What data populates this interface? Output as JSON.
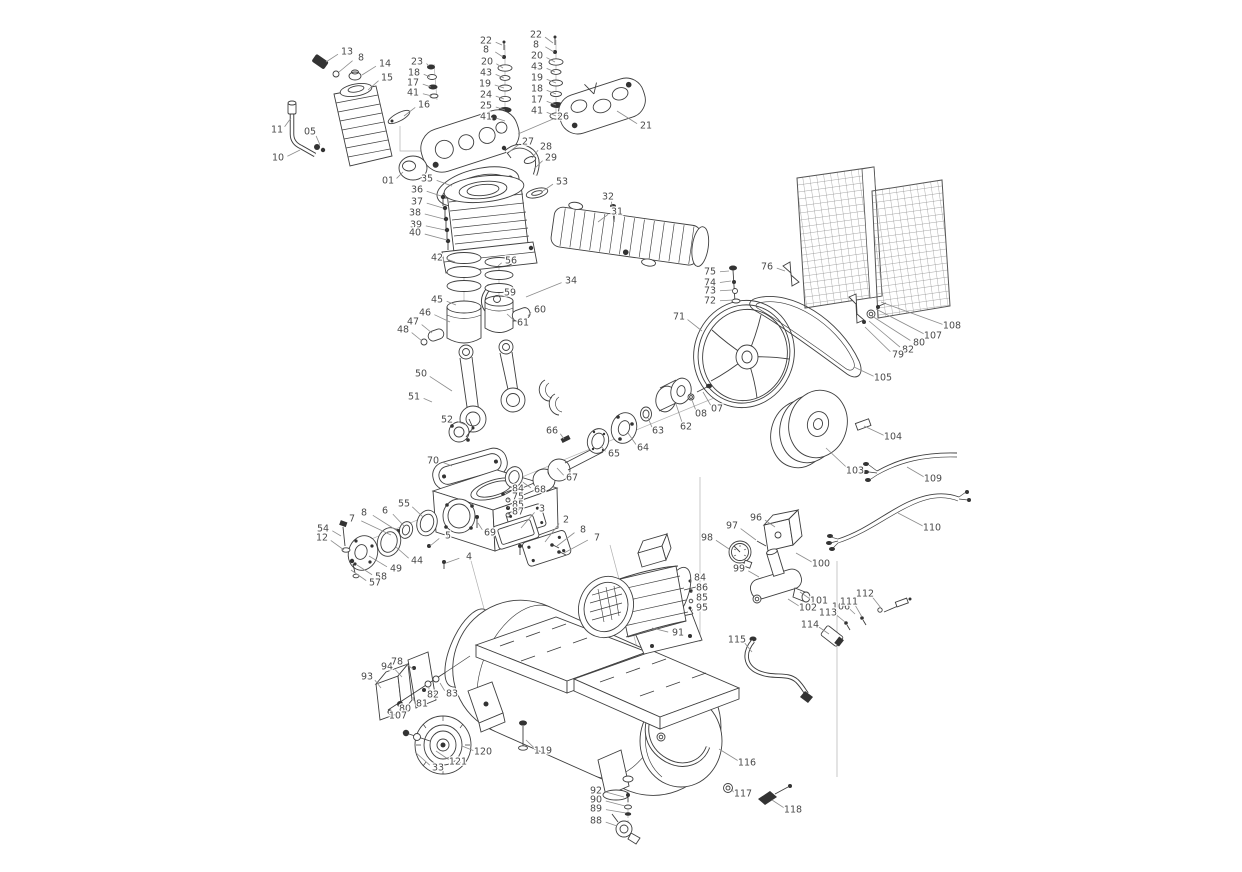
{
  "page": {
    "background": "#ffffff",
    "width": 1242,
    "height": 872
  },
  "diagram": {
    "type": "exploded-parts-diagram",
    "subject": "belt-driven air compressor exploded view with numbered part callouts",
    "label_style": {
      "color": "#4a4a4a",
      "leader_color": "#8c8c8c",
      "ink_color": "#3f3f3f",
      "font_size": 9.5
    },
    "callouts": [
      {
        "n": "13",
        "x": 347,
        "y": 52,
        "tx": 326,
        "ty": 62
      },
      {
        "n": "8",
        "x": 361,
        "y": 58,
        "tx": 339,
        "ty": 72
      },
      {
        "n": "14",
        "x": 385,
        "y": 64,
        "tx": 362,
        "ty": 75
      },
      {
        "n": "15",
        "x": 387,
        "y": 78,
        "tx": 368,
        "ty": 90
      },
      {
        "n": "11",
        "x": 277,
        "y": 130,
        "tx": 291,
        "ty": 118
      },
      {
        "n": "05",
        "x": 310,
        "y": 132,
        "tx": 320,
        "ty": 145
      },
      {
        "n": "10",
        "x": 278,
        "y": 158,
        "tx": 300,
        "ty": 150
      },
      {
        "n": "16",
        "x": 424,
        "y": 105,
        "tx": 404,
        "ty": 116
      },
      {
        "n": "01",
        "x": 388,
        "y": 181,
        "tx": 403,
        "ty": 172
      },
      {
        "n": "23",
        "x": 417,
        "y": 62,
        "tx": 429,
        "ty": 66
      },
      {
        "n": "18",
        "x": 414,
        "y": 73,
        "tx": 430,
        "ty": 77
      },
      {
        "n": "17",
        "x": 413,
        "y": 83,
        "tx": 431,
        "ty": 87
      },
      {
        "n": "41",
        "x": 413,
        "y": 93,
        "tx": 432,
        "ty": 96
      },
      {
        "n": "22",
        "x": 486,
        "y": 41,
        "tx": 502,
        "ty": 45
      },
      {
        "n": "8",
        "x": 486,
        "y": 50,
        "tx": 503,
        "ty": 57
      },
      {
        "n": "20",
        "x": 487,
        "y": 62,
        "tx": 503,
        "ty": 68
      },
      {
        "n": "43",
        "x": 486,
        "y": 73,
        "tx": 504,
        "ty": 78
      },
      {
        "n": "19",
        "x": 485,
        "y": 84,
        "tx": 504,
        "ty": 88
      },
      {
        "n": "24",
        "x": 486,
        "y": 95,
        "tx": 504,
        "ty": 99
      },
      {
        "n": "25",
        "x": 486,
        "y": 106,
        "tx": 505,
        "ty": 110
      },
      {
        "n": "41",
        "x": 486,
        "y": 117,
        "tx": 505,
        "ty": 121
      },
      {
        "n": "22",
        "x": 536,
        "y": 35,
        "tx": 553,
        "ty": 43
      },
      {
        "n": "8",
        "x": 536,
        "y": 45,
        "tx": 554,
        "ty": 52
      },
      {
        "n": "20",
        "x": 537,
        "y": 56,
        "tx": 555,
        "ty": 62
      },
      {
        "n": "43",
        "x": 537,
        "y": 67,
        "tx": 555,
        "ty": 72
      },
      {
        "n": "19",
        "x": 537,
        "y": 78,
        "tx": 556,
        "ty": 83
      },
      {
        "n": "18",
        "x": 537,
        "y": 89,
        "tx": 556,
        "ty": 94
      },
      {
        "n": "17",
        "x": 537,
        "y": 100,
        "tx": 556,
        "ty": 105
      },
      {
        "n": "41",
        "x": 537,
        "y": 111,
        "tx": 556,
        "ty": 116
      },
      {
        "n": "26",
        "x": 563,
        "y": 117,
        "tx": 518,
        "ty": 134
      },
      {
        "n": "21",
        "x": 646,
        "y": 126,
        "tx": 617,
        "ty": 111
      },
      {
        "n": "27",
        "x": 528,
        "y": 142,
        "tx": 509,
        "ty": 152
      },
      {
        "n": "28",
        "x": 546,
        "y": 147,
        "tx": 532,
        "ty": 158
      },
      {
        "n": "29",
        "x": 551,
        "y": 158,
        "tx": 534,
        "ty": 169
      },
      {
        "n": "53",
        "x": 562,
        "y": 182,
        "tx": 543,
        "ty": 191
      },
      {
        "n": "32",
        "x": 608,
        "y": 197,
        "tx": 613,
        "ty": 211
      },
      {
        "n": "31",
        "x": 617,
        "y": 212,
        "tx": 598,
        "ty": 222
      },
      {
        "n": "34",
        "x": 571,
        "y": 281,
        "tx": 526,
        "ty": 297
      },
      {
        "n": "35",
        "x": 427,
        "y": 179,
        "tx": 452,
        "ty": 186
      },
      {
        "n": "36",
        "x": 417,
        "y": 190,
        "tx": 441,
        "ty": 196
      },
      {
        "n": "37",
        "x": 417,
        "y": 202,
        "tx": 443,
        "ty": 208
      },
      {
        "n": "38",
        "x": 415,
        "y": 213,
        "tx": 444,
        "ty": 219
      },
      {
        "n": "39",
        "x": 416,
        "y": 225,
        "tx": 445,
        "ty": 230
      },
      {
        "n": "40",
        "x": 415,
        "y": 233,
        "tx": 447,
        "ty": 240
      },
      {
        "n": "42",
        "x": 437,
        "y": 258,
        "tx": 455,
        "ty": 262
      },
      {
        "n": "56",
        "x": 511,
        "y": 261,
        "tx": 498,
        "ty": 266
      },
      {
        "n": "59",
        "x": 510,
        "y": 293,
        "tx": 500,
        "ty": 298
      },
      {
        "n": "60",
        "x": 540,
        "y": 310,
        "tx": 528,
        "ty": 316
      },
      {
        "n": "61",
        "x": 523,
        "y": 323,
        "tx": 507,
        "ty": 314
      },
      {
        "n": "45",
        "x": 437,
        "y": 300,
        "tx": 456,
        "ty": 305
      },
      {
        "n": "46",
        "x": 425,
        "y": 313,
        "tx": 450,
        "ty": 322
      },
      {
        "n": "47",
        "x": 413,
        "y": 322,
        "tx": 432,
        "ty": 333
      },
      {
        "n": "48",
        "x": 403,
        "y": 330,
        "tx": 422,
        "ty": 341
      },
      {
        "n": "50",
        "x": 421,
        "y": 374,
        "tx": 452,
        "ty": 391
      },
      {
        "n": "51",
        "x": 414,
        "y": 397,
        "tx": 432,
        "ty": 402
      },
      {
        "n": "52",
        "x": 447,
        "y": 420,
        "tx": 466,
        "ty": 425
      },
      {
        "n": "66",
        "x": 552,
        "y": 431,
        "tx": 564,
        "ty": 439
      },
      {
        "n": "65",
        "x": 614,
        "y": 454,
        "tx": 601,
        "ty": 446
      },
      {
        "n": "64",
        "x": 643,
        "y": 448,
        "tx": 628,
        "ty": 433
      },
      {
        "n": "63",
        "x": 658,
        "y": 431,
        "tx": 648,
        "ty": 418
      },
      {
        "n": "62",
        "x": 686,
        "y": 427,
        "tx": 676,
        "ty": 404
      },
      {
        "n": "08",
        "x": 701,
        "y": 414,
        "tx": 692,
        "ty": 400
      },
      {
        "n": "07",
        "x": 717,
        "y": 409,
        "tx": 703,
        "ty": 392
      },
      {
        "n": "67",
        "x": 572,
        "y": 478,
        "tx": 557,
        "ty": 468
      },
      {
        "n": "68",
        "x": 540,
        "y": 490,
        "tx": 521,
        "ty": 481
      },
      {
        "n": "70",
        "x": 433,
        "y": 461,
        "tx": 452,
        "ty": 466
      },
      {
        "n": "55",
        "x": 404,
        "y": 504,
        "tx": 423,
        "ty": 517
      },
      {
        "n": "6",
        "x": 385,
        "y": 511,
        "tx": 404,
        "ty": 526
      },
      {
        "n": "8",
        "x": 364,
        "y": 513,
        "tx": 396,
        "ty": 530
      },
      {
        "n": "7",
        "x": 352,
        "y": 519,
        "tx": 391,
        "ty": 535
      },
      {
        "n": "54",
        "x": 323,
        "y": 529,
        "tx": 341,
        "ty": 536
      },
      {
        "n": "12",
        "x": 322,
        "y": 538,
        "tx": 344,
        "ty": 550
      },
      {
        "n": "44",
        "x": 417,
        "y": 561,
        "tx": 396,
        "ty": 547
      },
      {
        "n": "49",
        "x": 396,
        "y": 569,
        "tx": 369,
        "ty": 556
      },
      {
        "n": "58",
        "x": 381,
        "y": 577,
        "tx": 357,
        "ty": 565
      },
      {
        "n": "57",
        "x": 375,
        "y": 583,
        "tx": 351,
        "ty": 570
      },
      {
        "n": "69",
        "x": 490,
        "y": 533,
        "tx": 478,
        "ty": 523
      },
      {
        "n": "5",
        "x": 448,
        "y": 536,
        "tx": 430,
        "ty": 546
      },
      {
        "n": "4",
        "x": 469,
        "y": 557,
        "tx": 446,
        "ty": 563
      },
      {
        "n": "3",
        "x": 542,
        "y": 509,
        "tx": 521,
        "ty": 528
      },
      {
        "n": "2",
        "x": 566,
        "y": 520,
        "tx": 545,
        "ty": 542
      },
      {
        "n": "8",
        "x": 583,
        "y": 530,
        "tx": 557,
        "ty": 546
      },
      {
        "n": "7",
        "x": 597,
        "y": 538,
        "tx": 564,
        "ty": 553
      },
      {
        "n": "84",
        "x": 518,
        "y": 489,
        "tx": 509,
        "ty": 492
      },
      {
        "n": "75",
        "x": 518,
        "y": 497,
        "tx": 508,
        "ty": 500
      },
      {
        "n": "85",
        "x": 518,
        "y": 505,
        "tx": 508,
        "ty": 508
      },
      {
        "n": "87",
        "x": 518,
        "y": 512,
        "tx": 508,
        "ty": 515
      },
      {
        "n": "71",
        "x": 679,
        "y": 317,
        "tx": 702,
        "ty": 331
      },
      {
        "n": "75",
        "x": 710,
        "y": 272,
        "tx": 729,
        "ty": 271
      },
      {
        "n": "74",
        "x": 710,
        "y": 283,
        "tx": 731,
        "ty": 281
      },
      {
        "n": "73",
        "x": 710,
        "y": 291,
        "tx": 732,
        "ty": 290
      },
      {
        "n": "72",
        "x": 710,
        "y": 301,
        "tx": 733,
        "ty": 300
      },
      {
        "n": "76",
        "x": 767,
        "y": 267,
        "tx": 785,
        "ty": 271
      },
      {
        "n": "105",
        "x": 883,
        "y": 378,
        "tx": 854,
        "ty": 367
      },
      {
        "n": "108",
        "x": 952,
        "y": 326,
        "tx": 881,
        "ty": 302
      },
      {
        "n": "107",
        "x": 933,
        "y": 336,
        "tx": 876,
        "ty": 309
      },
      {
        "n": "80",
        "x": 919,
        "y": 343,
        "tx": 872,
        "ty": 316
      },
      {
        "n": "82",
        "x": 908,
        "y": 350,
        "tx": 869,
        "ty": 321
      },
      {
        "n": "79",
        "x": 898,
        "y": 355,
        "tx": 865,
        "ty": 327
      },
      {
        "n": "104",
        "x": 893,
        "y": 437,
        "tx": 864,
        "ty": 426
      },
      {
        "n": "103",
        "x": 855,
        "y": 471,
        "tx": 826,
        "ty": 448
      },
      {
        "n": "109",
        "x": 933,
        "y": 479,
        "tx": 907,
        "ty": 467
      },
      {
        "n": "110",
        "x": 932,
        "y": 528,
        "tx": 898,
        "ty": 513
      },
      {
        "n": "96",
        "x": 756,
        "y": 518,
        "tx": 775,
        "ty": 527
      },
      {
        "n": "97",
        "x": 732,
        "y": 526,
        "tx": 756,
        "ty": 540
      },
      {
        "n": "98",
        "x": 707,
        "y": 538,
        "tx": 729,
        "ty": 549
      },
      {
        "n": "99",
        "x": 739,
        "y": 569,
        "tx": 759,
        "ty": 577
      },
      {
        "n": "100",
        "x": 821,
        "y": 564,
        "tx": 796,
        "ty": 553
      },
      {
        "n": "101",
        "x": 819,
        "y": 601,
        "tx": 800,
        "ty": 592
      },
      {
        "n": "102",
        "x": 808,
        "y": 608,
        "tx": 788,
        "ty": 599
      },
      {
        "n": "106",
        "x": 841,
        "y": 607,
        "tx": 855,
        "ty": 614
      },
      {
        "n": "111",
        "x": 849,
        "y": 602,
        "tx": 862,
        "ty": 617
      },
      {
        "n": "112",
        "x": 865,
        "y": 594,
        "tx": 881,
        "ty": 608
      },
      {
        "n": "113",
        "x": 828,
        "y": 613,
        "tx": 845,
        "ty": 622
      },
      {
        "n": "114",
        "x": 810,
        "y": 625,
        "tx": 829,
        "ty": 634
      },
      {
        "n": "115",
        "x": 737,
        "y": 640,
        "tx": 752,
        "ty": 652
      },
      {
        "n": "91",
        "x": 678,
        "y": 633,
        "tx": 652,
        "ty": 628
      },
      {
        "n": "84",
        "x": 700,
        "y": 578,
        "tx": 691,
        "ty": 582
      },
      {
        "n": "86",
        "x": 702,
        "y": 588,
        "tx": 692,
        "ty": 592
      },
      {
        "n": "85",
        "x": 702,
        "y": 598,
        "tx": 692,
        "ty": 601
      },
      {
        "n": "95",
        "x": 702,
        "y": 608,
        "tx": 692,
        "ty": 611
      },
      {
        "n": "93",
        "x": 367,
        "y": 677,
        "tx": 381,
        "ty": 688
      },
      {
        "n": "94",
        "x": 387,
        "y": 667,
        "tx": 402,
        "ty": 677
      },
      {
        "n": "78",
        "x": 397,
        "y": 662,
        "tx": 413,
        "ty": 669
      },
      {
        "n": "82",
        "x": 433,
        "y": 695,
        "tx": 429,
        "ty": 686
      },
      {
        "n": "83",
        "x": 452,
        "y": 694,
        "tx": 440,
        "ty": 683
      },
      {
        "n": "81",
        "x": 422,
        "y": 704,
        "tx": 413,
        "ty": 697
      },
      {
        "n": "80",
        "x": 405,
        "y": 709,
        "tx": 401,
        "ty": 704
      },
      {
        "n": "107",
        "x": 398,
        "y": 716,
        "tx": 392,
        "ty": 711
      },
      {
        "n": "120",
        "x": 483,
        "y": 752,
        "tx": 462,
        "ty": 746
      },
      {
        "n": "121",
        "x": 458,
        "y": 762,
        "tx": 436,
        "ty": 751
      },
      {
        "n": "33",
        "x": 438,
        "y": 768,
        "tx": 415,
        "ty": 752
      },
      {
        "n": "119",
        "x": 543,
        "y": 751,
        "tx": 526,
        "ty": 740
      },
      {
        "n": "116",
        "x": 747,
        "y": 763,
        "tx": 719,
        "ty": 749
      },
      {
        "n": "117",
        "x": 743,
        "y": 794,
        "tx": 731,
        "ty": 789
      },
      {
        "n": "118",
        "x": 793,
        "y": 810,
        "tx": 772,
        "ty": 800
      },
      {
        "n": "92",
        "x": 596,
        "y": 791,
        "tx": 624,
        "ty": 797
      },
      {
        "n": "90",
        "x": 596,
        "y": 800,
        "tx": 625,
        "ty": 806
      },
      {
        "n": "89",
        "x": 596,
        "y": 809,
        "tx": 626,
        "ty": 813
      },
      {
        "n": "88",
        "x": 596,
        "y": 821,
        "tx": 617,
        "ty": 826
      }
    ]
  }
}
